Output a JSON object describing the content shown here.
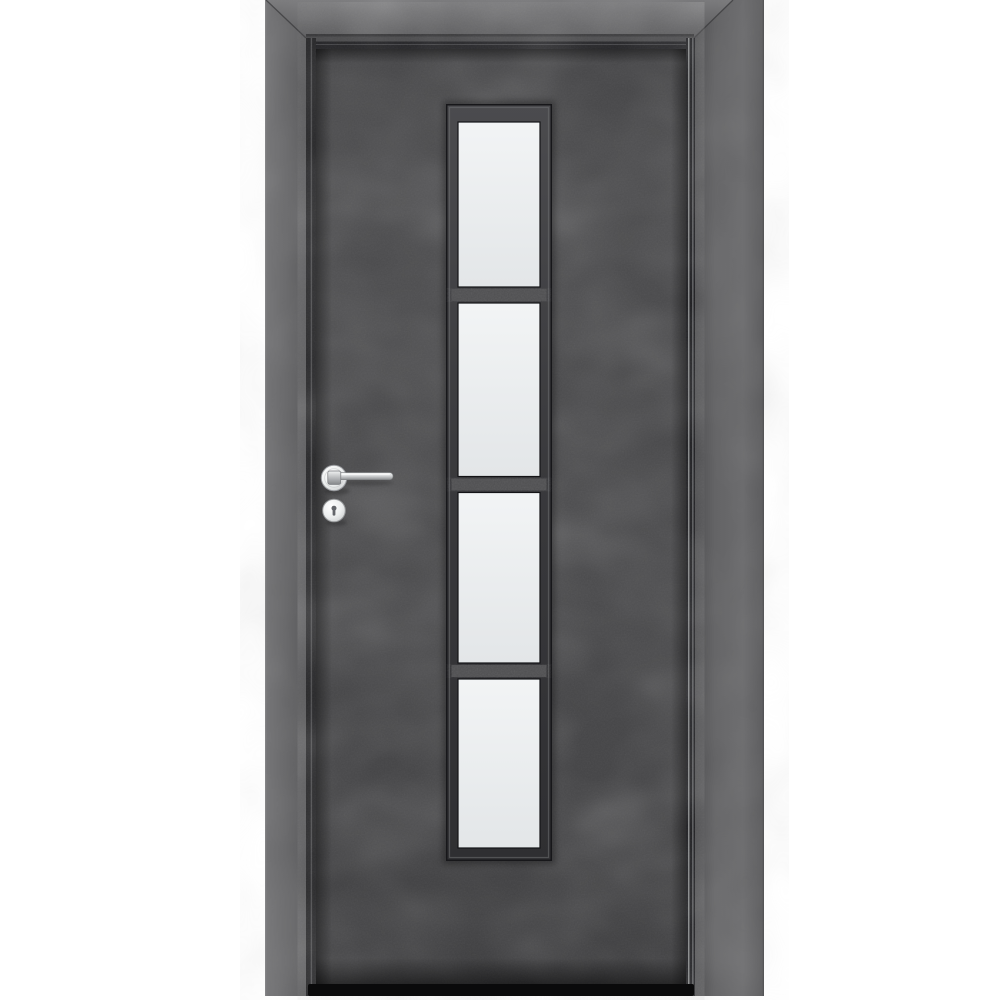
{
  "scene": {
    "type": "product-photo",
    "subject": "interior door with dark concrete finish and vertical 4-pane frosted glazing strip",
    "view": "front",
    "background_color": "#ffffff"
  },
  "door": {
    "leaf": {
      "finish": "dark concrete",
      "base_color": "#4a4a4c"
    },
    "frame": {
      "finish": "dark concrete",
      "casing_light": "#737375",
      "casing_dark": "#545456",
      "gap_shadow_color": "#242427",
      "gap_highlight_color": "#9a9c9e"
    },
    "threshold": {
      "color": "#0a0a0b"
    },
    "glazing": {
      "pane_count": 4,
      "divider_count": 3,
      "frame_color_top": "#4b4b4e",
      "frame_color_bottom": "#2f2f32",
      "divider_color": "#515153",
      "glass_top_color": "#f2f4f5",
      "glass_bottom_color": "#e3e6e8"
    },
    "hardware": {
      "finish": "silver chrome",
      "parts": [
        "lever-handle",
        "round-rosette",
        "keyhole-escutcheon"
      ],
      "chrome_light": "#f7f8f8",
      "chrome_mid": "#c7c9ca",
      "chrome_dark": "#8f9193",
      "keyhole_color": "#63656a"
    }
  }
}
